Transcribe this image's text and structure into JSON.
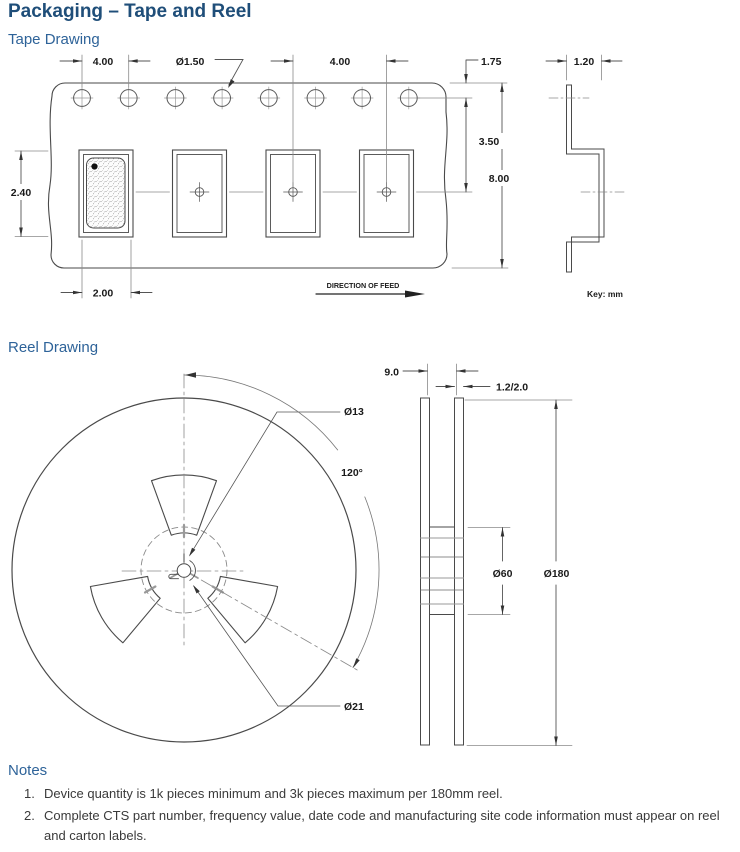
{
  "page": {
    "title": "Packaging – Tape and Reel",
    "key_label": "Key: mm"
  },
  "tape": {
    "section_title": "Tape Drawing",
    "direction_label": "DIRECTION OF FEED",
    "dims": {
      "hole_pitch": "4.00",
      "hole_diameter": "Ø1.50",
      "pocket_pitch": "4.00",
      "edge_to_hole": "1.75",
      "hole_to_pocket_center": "3.50",
      "tape_width": "8.00",
      "pocket_length": "2.40",
      "pocket_width": "2.00",
      "section_width": "1.20"
    }
  },
  "reel": {
    "section_title": "Reel Drawing",
    "dims": {
      "inner_width": "9.0",
      "flange_thickness": "1.2/2.0",
      "arbor_hole_diameter": "Ø13",
      "window_angle": "120°",
      "hub_diameter": "Ø60",
      "reel_diameter": "Ø180",
      "keyway_diameter": "Ø21"
    }
  },
  "notes": {
    "section_title": "Notes",
    "items": [
      {
        "number": "1.",
        "text": "Device quantity is 1k pieces minimum and 3k pieces maximum per 180mm reel."
      },
      {
        "number": "2.",
        "text": "Complete CTS part number, frequency value, date code and manufacturing site code information must appear on reel and carton labels."
      }
    ]
  },
  "colors": {
    "title_blue": "#1F4E79",
    "subheading_blue": "#2E6399",
    "line": "#4a4a4a"
  }
}
